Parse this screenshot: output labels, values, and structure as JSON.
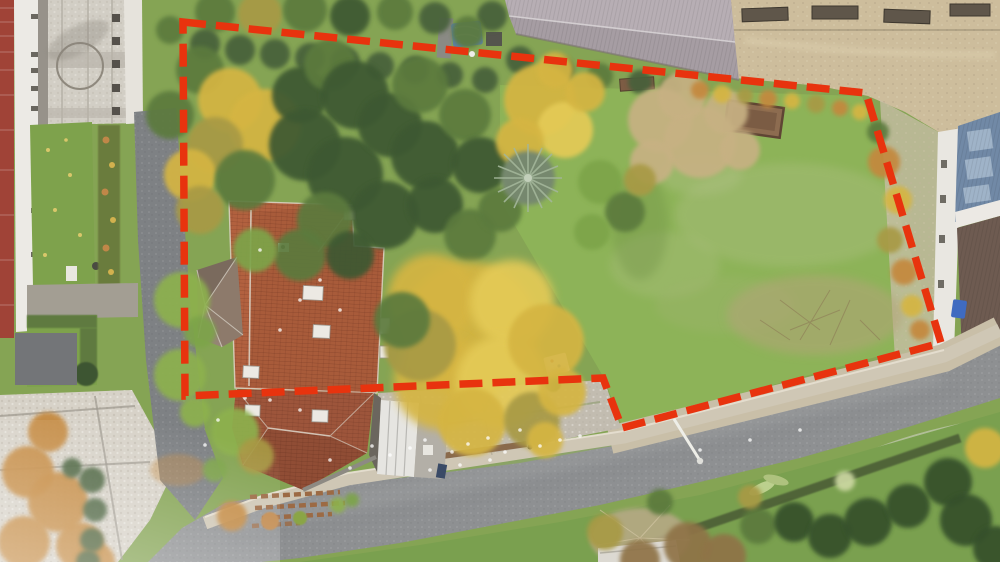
{
  "meta": {
    "type": "aerial-drone-photograph",
    "subject": "building plot with detached house, autumn garden and large lawn, outlined for real-estate listing",
    "season": "autumn",
    "no_text_in_image": true
  },
  "overlay": {
    "boundary_points": "183,22 866,93 941,343 622,428 603,378 185,396",
    "boundary_color": "#e8330e",
    "boundary_dash": "23 10",
    "boundary_stroke_width": "7.5"
  },
  "palette": {
    "grass": "#85a454",
    "lawn_bright": "#8db358",
    "lawn_light_patch": "#a9bd7c",
    "road": "#8e9092",
    "left_road": "#7e8184",
    "sidewalk": "#cfc7b5",
    "gravel_verge": "#c9bfa8",
    "plaza_pavers": "#d2cec5",
    "cobbles": "#d7d2c8",
    "dirt_yard": "#cdbd9c",
    "roof_main": "#b2613f",
    "roof_annex": "#9d553b",
    "roof_bay": "#8d7a6b",
    "carport_white": "#e6e5e1",
    "barn_roof_light": "#b7aeb4",
    "barn_roof_dark": "#a69da3",
    "blue_roof": "#7189a6",
    "bronze_roof": "#6e5b51",
    "white_building": "#eceae5",
    "brick_building": "#a04337",
    "raised_bed": "#8d6c50",
    "deep": "#3c5831",
    "green": "#5b7a3d",
    "lime": "#7da449",
    "bright": "#8db14e",
    "gold": "#d5b542",
    "goldL": "#e4ca57",
    "olive": "#a89a45",
    "tan": "#c7b183",
    "hedge": "#47603a",
    "orange": "#c4883e",
    "brown": "#8f7347",
    "dark": "#34502c",
    "dry": "#b6a985",
    "pale": "#ccd8a2"
  },
  "vegetation": {
    "blobs": [
      [
        215,
        12,
        20,
        "green"
      ],
      [
        260,
        14,
        22,
        "olive"
      ],
      [
        305,
        10,
        22,
        "green"
      ],
      [
        350,
        16,
        20,
        "deep"
      ],
      [
        395,
        12,
        18,
        "green"
      ],
      [
        435,
        18,
        16,
        "hedge"
      ],
      [
        170,
        30,
        14,
        "green"
      ],
      [
        205,
        44,
        15,
        "hedge"
      ],
      [
        240,
        50,
        15,
        "hedge"
      ],
      [
        275,
        54,
        15,
        "hedge"
      ],
      [
        310,
        58,
        15,
        "hedge"
      ],
      [
        345,
        62,
        15,
        "hedge"
      ],
      [
        380,
        66,
        14,
        "hedge"
      ],
      [
        415,
        70,
        14,
        "hedge"
      ],
      [
        450,
        75,
        13,
        "hedge"
      ],
      [
        485,
        80,
        13,
        "hedge"
      ],
      [
        520,
        60,
        14,
        "hedge"
      ],
      [
        560,
        70,
        14,
        "hedge"
      ],
      [
        600,
        76,
        13,
        "green"
      ],
      [
        640,
        82,
        12,
        "hedge"
      ],
      [
        670,
        86,
        11,
        "green"
      ],
      [
        200,
        70,
        24,
        "green"
      ],
      [
        230,
        100,
        32,
        "gold"
      ],
      [
        265,
        125,
        36,
        "gold"
      ],
      [
        300,
        95,
        28,
        "deep"
      ],
      [
        330,
        65,
        26,
        "green"
      ],
      [
        215,
        145,
        28,
        "olive"
      ],
      [
        190,
        175,
        26,
        "gold"
      ],
      [
        245,
        180,
        30,
        "green"
      ],
      [
        200,
        210,
        24,
        "olive"
      ],
      [
        170,
        115,
        24,
        "green"
      ],
      [
        355,
        95,
        34,
        "deep"
      ],
      [
        305,
        145,
        36,
        "deep"
      ],
      [
        345,
        175,
        38,
        "deep"
      ],
      [
        390,
        125,
        32,
        "deep"
      ],
      [
        420,
        85,
        28,
        "green"
      ],
      [
        425,
        155,
        34,
        "deep"
      ],
      [
        385,
        215,
        34,
        "deep"
      ],
      [
        325,
        220,
        28,
        "green"
      ],
      [
        435,
        205,
        28,
        "deep"
      ],
      [
        465,
        115,
        26,
        "green"
      ],
      [
        480,
        165,
        28,
        "deep"
      ],
      [
        470,
        235,
        26,
        "green"
      ],
      [
        300,
        255,
        26,
        "green"
      ],
      [
        255,
        250,
        22,
        "lime"
      ],
      [
        350,
        255,
        24,
        "deep"
      ],
      [
        500,
        210,
        22,
        "green"
      ],
      [
        540,
        100,
        36,
        "gold"
      ],
      [
        565,
        130,
        28,
        "goldL"
      ],
      [
        520,
        142,
        24,
        "gold"
      ],
      [
        585,
        92,
        20,
        "gold"
      ],
      [
        555,
        70,
        18,
        "gold"
      ],
      [
        660,
        120,
        32,
        "tan"
      ],
      [
        700,
        142,
        36,
        "tan"
      ],
      [
        682,
        96,
        24,
        "tan"
      ],
      [
        726,
        112,
        22,
        "tan"
      ],
      [
        652,
        162,
        22,
        "tan"
      ],
      [
        740,
        150,
        20,
        "tan"
      ],
      [
        600,
        182,
        22,
        "lime"
      ],
      [
        625,
        212,
        20,
        "green"
      ],
      [
        592,
        232,
        18,
        "lime"
      ],
      [
        640,
        180,
        16,
        "olive"
      ],
      [
        700,
        90,
        9,
        "orange"
      ],
      [
        722,
        94,
        9,
        "gold"
      ],
      [
        745,
        96,
        8,
        "olive"
      ],
      [
        768,
        99,
        9,
        "orange"
      ],
      [
        792,
        101,
        8,
        "gold"
      ],
      [
        816,
        104,
        9,
        "olive"
      ],
      [
        840,
        108,
        8,
        "orange"
      ],
      [
        860,
        112,
        8,
        "gold"
      ],
      [
        470,
        330,
        68,
        "gold"
      ],
      [
        432,
        298,
        44,
        "gold"
      ],
      [
        512,
        302,
        42,
        "goldL"
      ],
      [
        442,
        382,
        48,
        "gold"
      ],
      [
        502,
        382,
        46,
        "goldL"
      ],
      [
        546,
        342,
        38,
        "gold"
      ],
      [
        420,
        345,
        36,
        "olive"
      ],
      [
        472,
        422,
        34,
        "gold"
      ],
      [
        532,
        420,
        28,
        "olive"
      ],
      [
        402,
        320,
        28,
        "green"
      ],
      [
        562,
        392,
        24,
        "gold"
      ],
      [
        545,
        440,
        18,
        "gold"
      ],
      [
        182,
        300,
        28,
        "bright"
      ],
      [
        180,
        375,
        26,
        "bright"
      ],
      [
        200,
        332,
        16,
        "lime"
      ],
      [
        195,
        412,
        15,
        "bright"
      ],
      [
        235,
        432,
        24,
        "bright"
      ],
      [
        256,
        456,
        18,
        "olive"
      ],
      [
        232,
        516,
        15,
        "orange"
      ],
      [
        215,
        470,
        12,
        "lime"
      ],
      [
        884,
        162,
        16,
        "orange"
      ],
      [
        898,
        200,
        14,
        "gold"
      ],
      [
        890,
        240,
        13,
        "olive"
      ],
      [
        904,
        272,
        13,
        "orange"
      ],
      [
        912,
        306,
        11,
        "gold"
      ],
      [
        878,
        132,
        11,
        "green"
      ],
      [
        920,
        330,
        10,
        "orange"
      ],
      [
        688,
        546,
        24,
        "brown"
      ],
      [
        724,
        556,
        22,
        "brown"
      ],
      [
        758,
        526,
        18,
        "green"
      ],
      [
        794,
        522,
        20,
        "dark"
      ],
      [
        830,
        536,
        22,
        "dark"
      ],
      [
        868,
        522,
        24,
        "dark"
      ],
      [
        908,
        506,
        22,
        "dark"
      ],
      [
        948,
        482,
        24,
        "dark"
      ],
      [
        985,
        448,
        20,
        "gold"
      ],
      [
        966,
        520,
        26,
        "dark"
      ],
      [
        995,
        548,
        22,
        "dark"
      ],
      [
        605,
        532,
        18,
        "olive"
      ],
      [
        660,
        502,
        13,
        "green"
      ],
      [
        750,
        497,
        12,
        "olive"
      ],
      [
        845,
        481,
        10,
        "pale"
      ],
      [
        640,
        560,
        20,
        "brown"
      ],
      [
        28,
        472,
        26,
        "orange"
      ],
      [
        58,
        502,
        30,
        "orange"
      ],
      [
        24,
        542,
        26,
        "orange"
      ],
      [
        80,
        546,
        24,
        "orange"
      ],
      [
        48,
        432,
        20,
        "orange"
      ],
      [
        95,
        562,
        20,
        "orange"
      ],
      [
        92,
        480,
        13,
        "hedge"
      ],
      [
        95,
        510,
        12,
        "hedge"
      ],
      [
        92,
        540,
        12,
        "hedge"
      ],
      [
        72,
        468,
        10,
        "hedge"
      ],
      [
        88,
        562,
        12,
        "hedge"
      ],
      [
        492,
        16,
        15,
        "hedge"
      ],
      [
        468,
        32,
        16,
        "green"
      ],
      [
        338,
        505,
        8,
        "bright"
      ],
      [
        352,
        500,
        7,
        "lime"
      ]
    ]
  },
  "specks": [
    [
      372,
      446
    ],
    [
      390,
      455
    ],
    [
      410,
      448
    ],
    [
      425,
      440
    ],
    [
      452,
      452
    ],
    [
      468,
      444
    ],
    [
      488,
      438
    ],
    [
      505,
      452
    ],
    [
      520,
      430
    ],
    [
      540,
      446
    ],
    [
      300,
      410
    ],
    [
      270,
      400
    ],
    [
      245,
      398
    ],
    [
      218,
      420
    ],
    [
      205,
      445
    ],
    [
      350,
      468
    ],
    [
      330,
      460
    ],
    [
      430,
      470
    ],
    [
      460,
      465
    ],
    [
      490,
      460
    ],
    [
      560,
      440
    ],
    [
      580,
      436
    ],
    [
      300,
      300
    ],
    [
      320,
      280
    ],
    [
      280,
      330
    ],
    [
      260,
      250
    ],
    [
      340,
      310
    ],
    [
      700,
      450
    ],
    [
      750,
      440
    ],
    [
      800,
      430
    ]
  ],
  "scene": {
    "regions": [
      "red dashed property boundary outline",
      "detached house with red tiled hip roof, pointed bay roof, rear annex roof, white carport",
      "large green lawn in eastern half of plot",
      "dense autumn trees (green, golden, tan) and tall spruce in western half",
      "wooden raised bed and bench on lawn",
      "asphalt street running diagonally along the south edge with gravel verge and street lamp",
      "narrow asphalt lane and paved plaza with lawn strips on the west (school yard)",
      "white elongated building and brick building on far left",
      "grey corrugated barn roof and sandy farm yard with troughs to the north",
      "farm buildings with blue and bronze metal roofs on the east edge",
      "cottage garden with shrubs and conifers in the south-east corner"
    ]
  }
}
